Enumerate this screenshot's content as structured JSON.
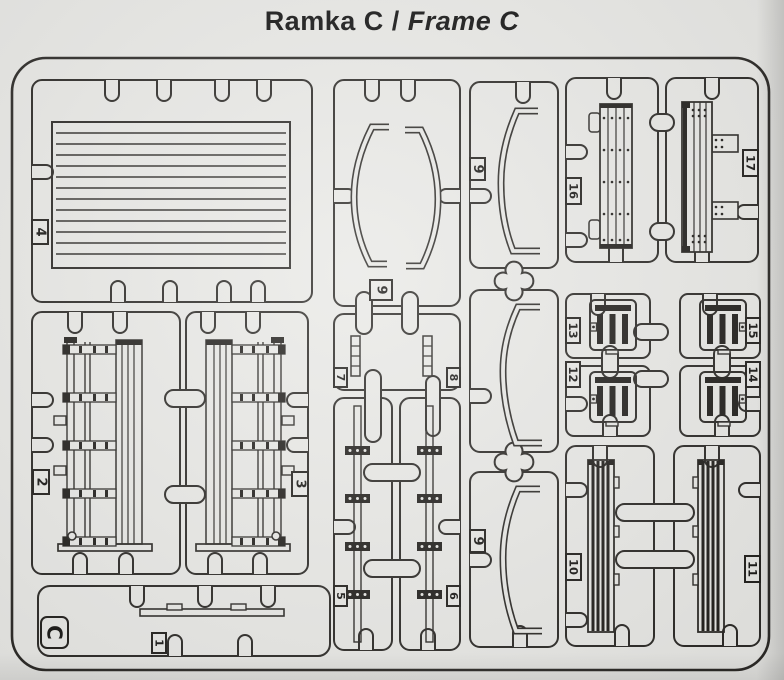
{
  "title": {
    "kit_frame_name_pl": "Ramka C",
    "separator": "/",
    "kit_frame_name_en": "Frame C"
  },
  "sprue": {
    "frame_letter": "C",
    "part_labels": {
      "p1": "1",
      "p2": "2",
      "p3": "3",
      "p4": "4",
      "p5": "5",
      "p6": "6",
      "p7": "7",
      "p8": "8",
      "p9": "9",
      "p10": "10",
      "p11": "11",
      "p12": "12",
      "p13": "13",
      "p14": "14",
      "p15": "15",
      "p16": "16",
      "p17": "17"
    },
    "colors": {
      "paper": "#e9e9e6",
      "line": "#2e2c29",
      "ink": "#1b1a18"
    }
  }
}
